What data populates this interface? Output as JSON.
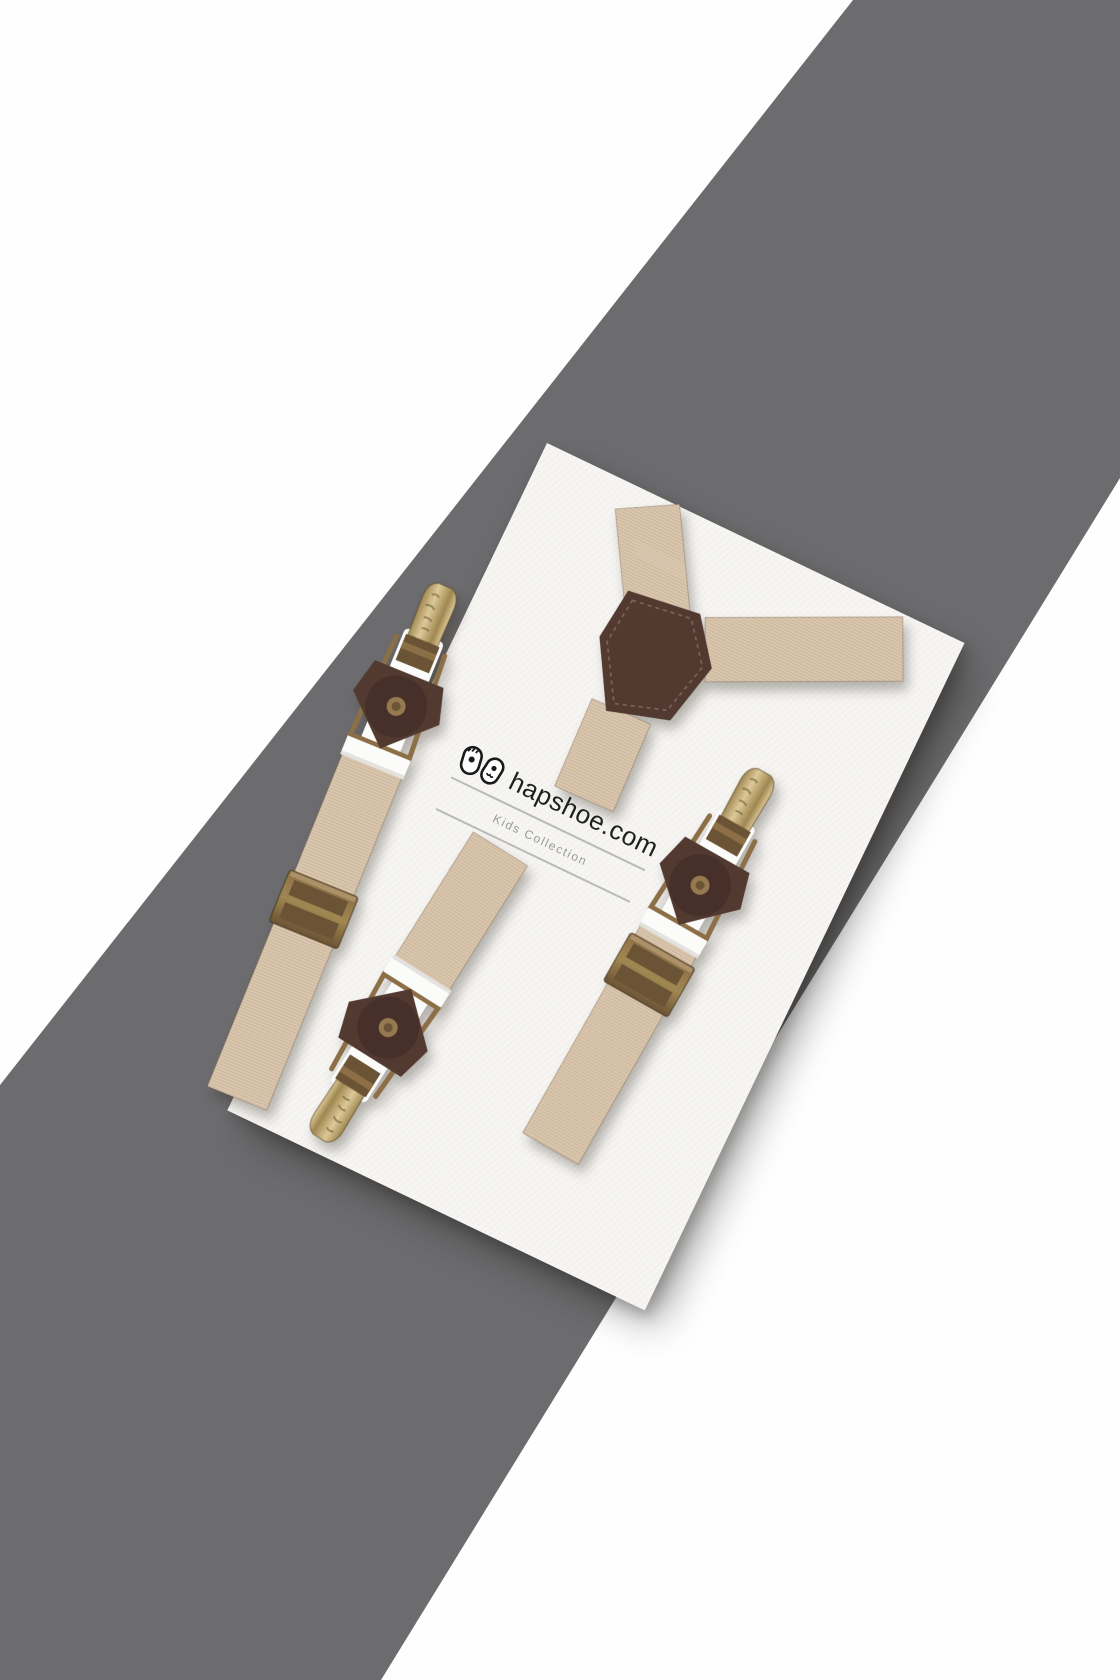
{
  "scene": {
    "description": "Product photograph of kids suspenders displayed on a tilted white card over a diagonal gray band",
    "logo": {
      "brand": "hapshoe.com",
      "collection": "Kids Collection"
    },
    "product": {
      "name": "kids suspenders",
      "parts": [
        "y-back elastic strap",
        "brown leather y-patch",
        "left strap with bronze clip",
        "right strap with bronze clip",
        "bottom strap with bronze clip",
        "bronze slide adjusters",
        "leather clip mounts with rivets"
      ]
    },
    "colors": {
      "page_bg": "#fefefe",
      "band_gray": "#6c6b6d",
      "card_white": "#f8f7f4",
      "strap_beige": "#d9c6ae",
      "strap_weave": "#c2ab8d",
      "leather_brown": "#523a31",
      "leather_flap": "#463029",
      "brass_light": "#dcc998",
      "brass_dark": "#a08751",
      "bronze": "#8d6f47",
      "bronze_dark": "#6b5335",
      "rivet": "#96794f",
      "white_slide": "#fbfbf9",
      "logo_text": "#1f1f1f",
      "collection_text": "#9a9a9a",
      "divider": "#a6a6a6"
    }
  }
}
